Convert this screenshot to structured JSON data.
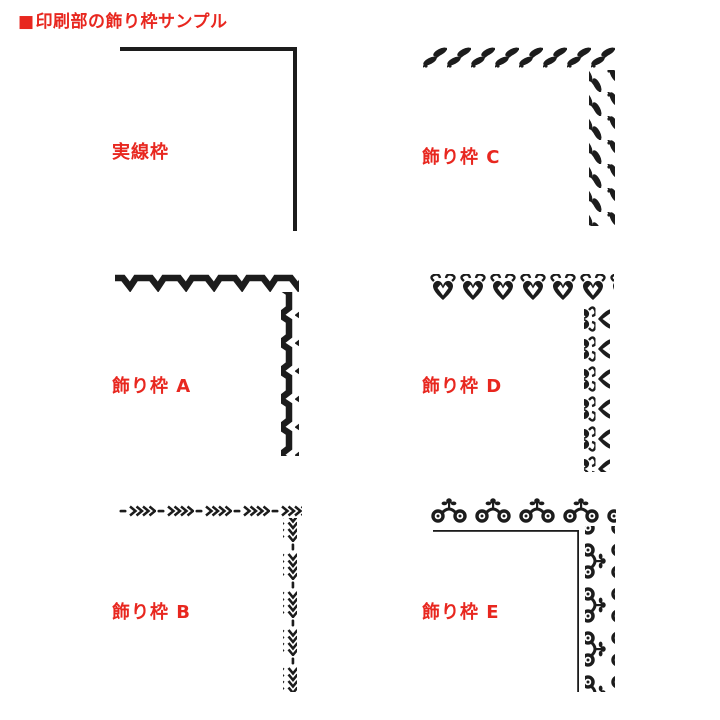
{
  "header": {
    "marker": "■",
    "title": "印刷部の飾り枠サンプル"
  },
  "colors": {
    "accent_red": "#e8271f",
    "ink_black": "#1c1c1c",
    "background": "#ffffff"
  },
  "samples": [
    {
      "label": "実線枠",
      "style": "solid-line-frame"
    },
    {
      "label": "飾り枠 C",
      "style": "leaf-vine-frame"
    },
    {
      "label": "飾り枠 A",
      "style": "twisted-ribbon-frame"
    },
    {
      "label": "飾り枠 D",
      "style": "heart-ornament-frame"
    },
    {
      "label": "飾り枠 B",
      "style": "chevron-chain-frame"
    },
    {
      "label": "飾り枠 E",
      "style": "scroll-flower-frame"
    }
  ]
}
